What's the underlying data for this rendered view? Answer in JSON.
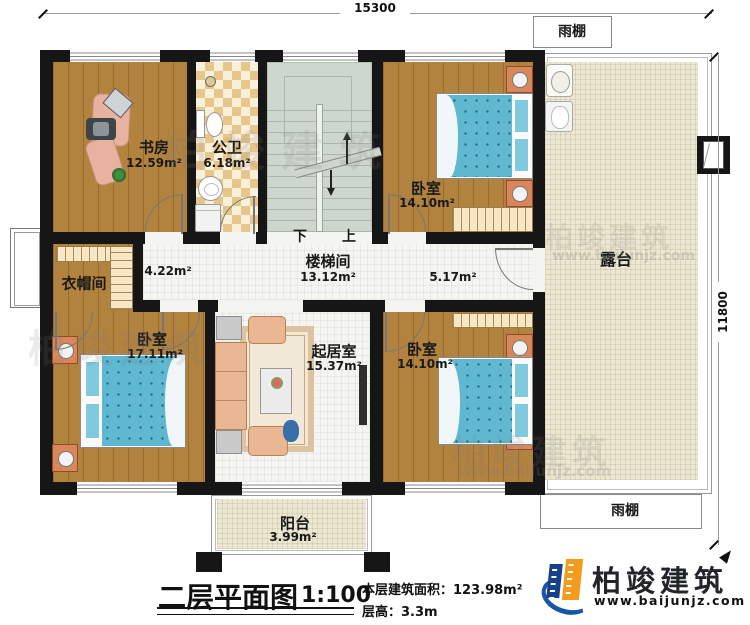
{
  "dimensions": {
    "top_width": "15300",
    "right_height": "11800"
  },
  "rooms": {
    "study": {
      "name": "书房",
      "area": "12.59m²"
    },
    "public_bath": {
      "name": "公卫",
      "area": "6.18m²"
    },
    "stairwell": {
      "name": "楼梯间",
      "area": "13.12m²",
      "down": "下",
      "up": "上"
    },
    "bedroom_top_right": {
      "name": "卧室",
      "area": "14.10m²"
    },
    "bedroom_bottom_left": {
      "name": "卧室",
      "area": "17.11m²"
    },
    "bedroom_bottom_right": {
      "name": "卧室",
      "area": "14.10m²"
    },
    "living_room": {
      "name": "起居室",
      "area": "15.37m²"
    },
    "cloakroom": {
      "name": "衣帽间"
    },
    "terrace": {
      "name": "露台"
    },
    "balcony": {
      "name": "阳台",
      "area": "3.99m²"
    },
    "canopy_top": {
      "name": "雨棚"
    },
    "canopy_bottom": {
      "name": "雨棚"
    },
    "hallway": {
      "left_area": "4.22m²",
      "right_area": "5.17m²"
    }
  },
  "title_block": {
    "title": "二层平面图",
    "scale": "1:100",
    "floor_area": "本层建筑面积：123.98m²",
    "floor_height": "层高：3.3m"
  },
  "brand": {
    "name": "柏竣建筑",
    "url": "www.baijunjz.com"
  },
  "watermark": {
    "name": "柏竣建筑",
    "url": "www.baijunjz.com"
  },
  "colors": {
    "wall": "#161616",
    "wood": "#b2823f",
    "tile": "#f5f5f1",
    "terrace": "#ece7d2",
    "stair": "#ced7cd",
    "bed": "#5fb7d0",
    "checker": "#e7c68c",
    "brand_blue": "#1a56a8",
    "brand_orange": "#f29b1d"
  }
}
